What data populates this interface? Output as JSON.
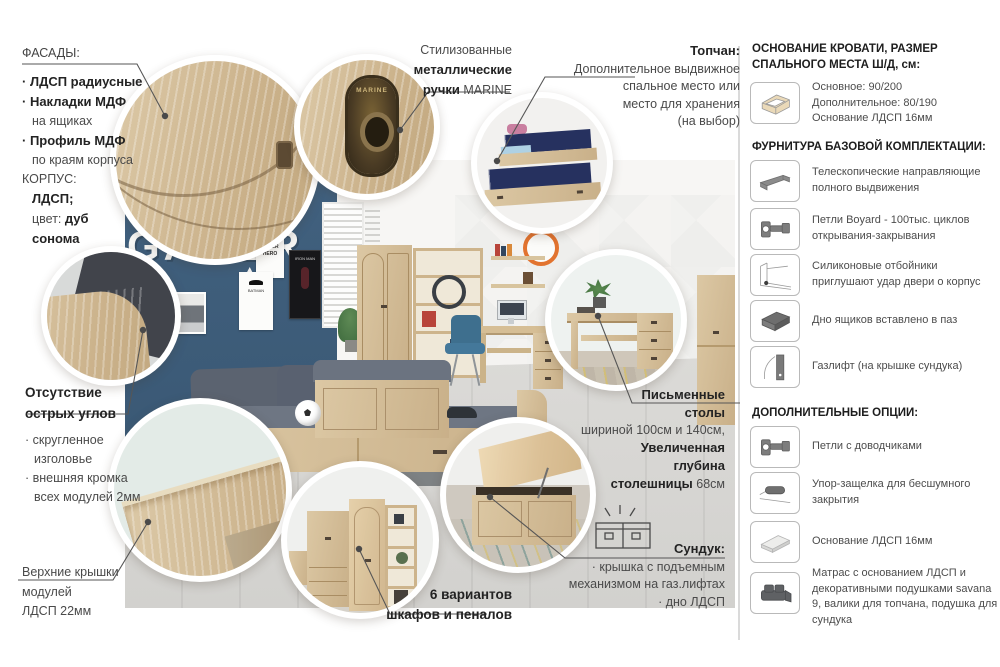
{
  "colors": {
    "accent_wood": "#cdb28c",
    "blue_wall": "#3e5c7a",
    "navy_bedding": "#26315f",
    "clock_orange": "#e2732f",
    "text_dark": "#232323",
    "text_body": "#4a4a4a"
  },
  "annotations": {
    "facades": {
      "title": "ФАСАДЫ:",
      "item1": "· ЛДСП радиусные",
      "item2": "· Накладки МДФ",
      "item2b": "на ящиках",
      "item3": "· Профиль МДФ",
      "item3b": "по краям корпуса",
      "korpus": "КОРПУС:",
      "korpus_value": "ЛДСП;",
      "color_label": "цвет:",
      "color_value": "дуб сонома"
    },
    "handles": {
      "line1": "Стилизованные",
      "line2": "металлические",
      "line3_bold": "ручки",
      "line3_normal": " MARINE"
    },
    "topchan": {
      "title": "Топчан:",
      "line1": "Дополнительное выдвижное",
      "line2": "спальное место или",
      "line3": "место для хранения",
      "line4": "(на выбор)"
    },
    "corners": {
      "title": "Отсутствие острых углов",
      "bullet1": "· скругленное изголовье",
      "bullet2": "· внешняя кромка всех модулей 2мм"
    },
    "tops": {
      "line1": "Верхние крышки",
      "line2": "модулей",
      "line3": "ЛДСП 22мм"
    },
    "variants": {
      "line1": "6 вариантов",
      "line2": "шкафов и пеналов"
    },
    "desks": {
      "line1": "Письменные",
      "line2": "столы",
      "line3": "шириной 100см и 140см,",
      "line4": "Увеличенная",
      "line5": "глубина",
      "line6_bold": "столешницы",
      "line6_normal": " 68см"
    },
    "chest": {
      "title": "Сундук:",
      "line1": "· крышка с подъемным",
      "line2": "механизмом на газ.лифтах",
      "line3": "· дно ЛДСП"
    }
  },
  "right_panel": {
    "bed_base": {
      "title": "ОСНОВАНИЕ КРОВАТИ, РАЗМЕР СПАЛЬНОГО МЕСТА Ш/Д, см:",
      "icon": "bed-base-icon",
      "line1": "Основное: 90/200",
      "line2": "Дополнительное: 80/190",
      "line3": "Основание ЛДСП 16мм"
    },
    "hardware": {
      "title": "ФУРНИТУРА БАЗОВОЙ КОМПЛЕКТАЦИИ:",
      "items": [
        {
          "icon": "telescopic-slide-icon",
          "text": "Телескопические направляющие полного выдвижения"
        },
        {
          "icon": "hinge-icon",
          "text": "Петли Boyard - 100тыс. циклов открывания-закрывания"
        },
        {
          "icon": "silicone-bumper-icon",
          "text": "Силиконовые отбойники приглушают удар двери о корпус"
        },
        {
          "icon": "drawer-bottom-icon",
          "text": "Дно ящиков вставлено в паз"
        },
        {
          "icon": "gas-lift-icon",
          "text": "Газлифт (на крышке сундука)"
        }
      ]
    },
    "options": {
      "title": "ДОПОЛНИТЕЛЬНЫЕ ОПЦИИ:",
      "items": [
        {
          "icon": "soft-close-hinge-icon",
          "text": "Петли с доводчиками"
        },
        {
          "icon": "push-latch-icon",
          "text": "Упор-защелка для бесшумного закрытия"
        },
        {
          "icon": "ldsp-base-icon",
          "text": "Основание ЛДСП 16мм"
        },
        {
          "icon": "mattress-icon",
          "text": "Матрас с основанием ЛДСП и декоративными подушками savana 9, валики для топчана, подушка для сундука"
        }
      ]
    }
  },
  "room": {
    "wall_text": "GAMER",
    "poster_super_hero": "I'M A SUPER HERO",
    "poster_batman": "BATMAN",
    "poster_iron_man": "IRON MAN",
    "handle_brand": "MARINE"
  }
}
